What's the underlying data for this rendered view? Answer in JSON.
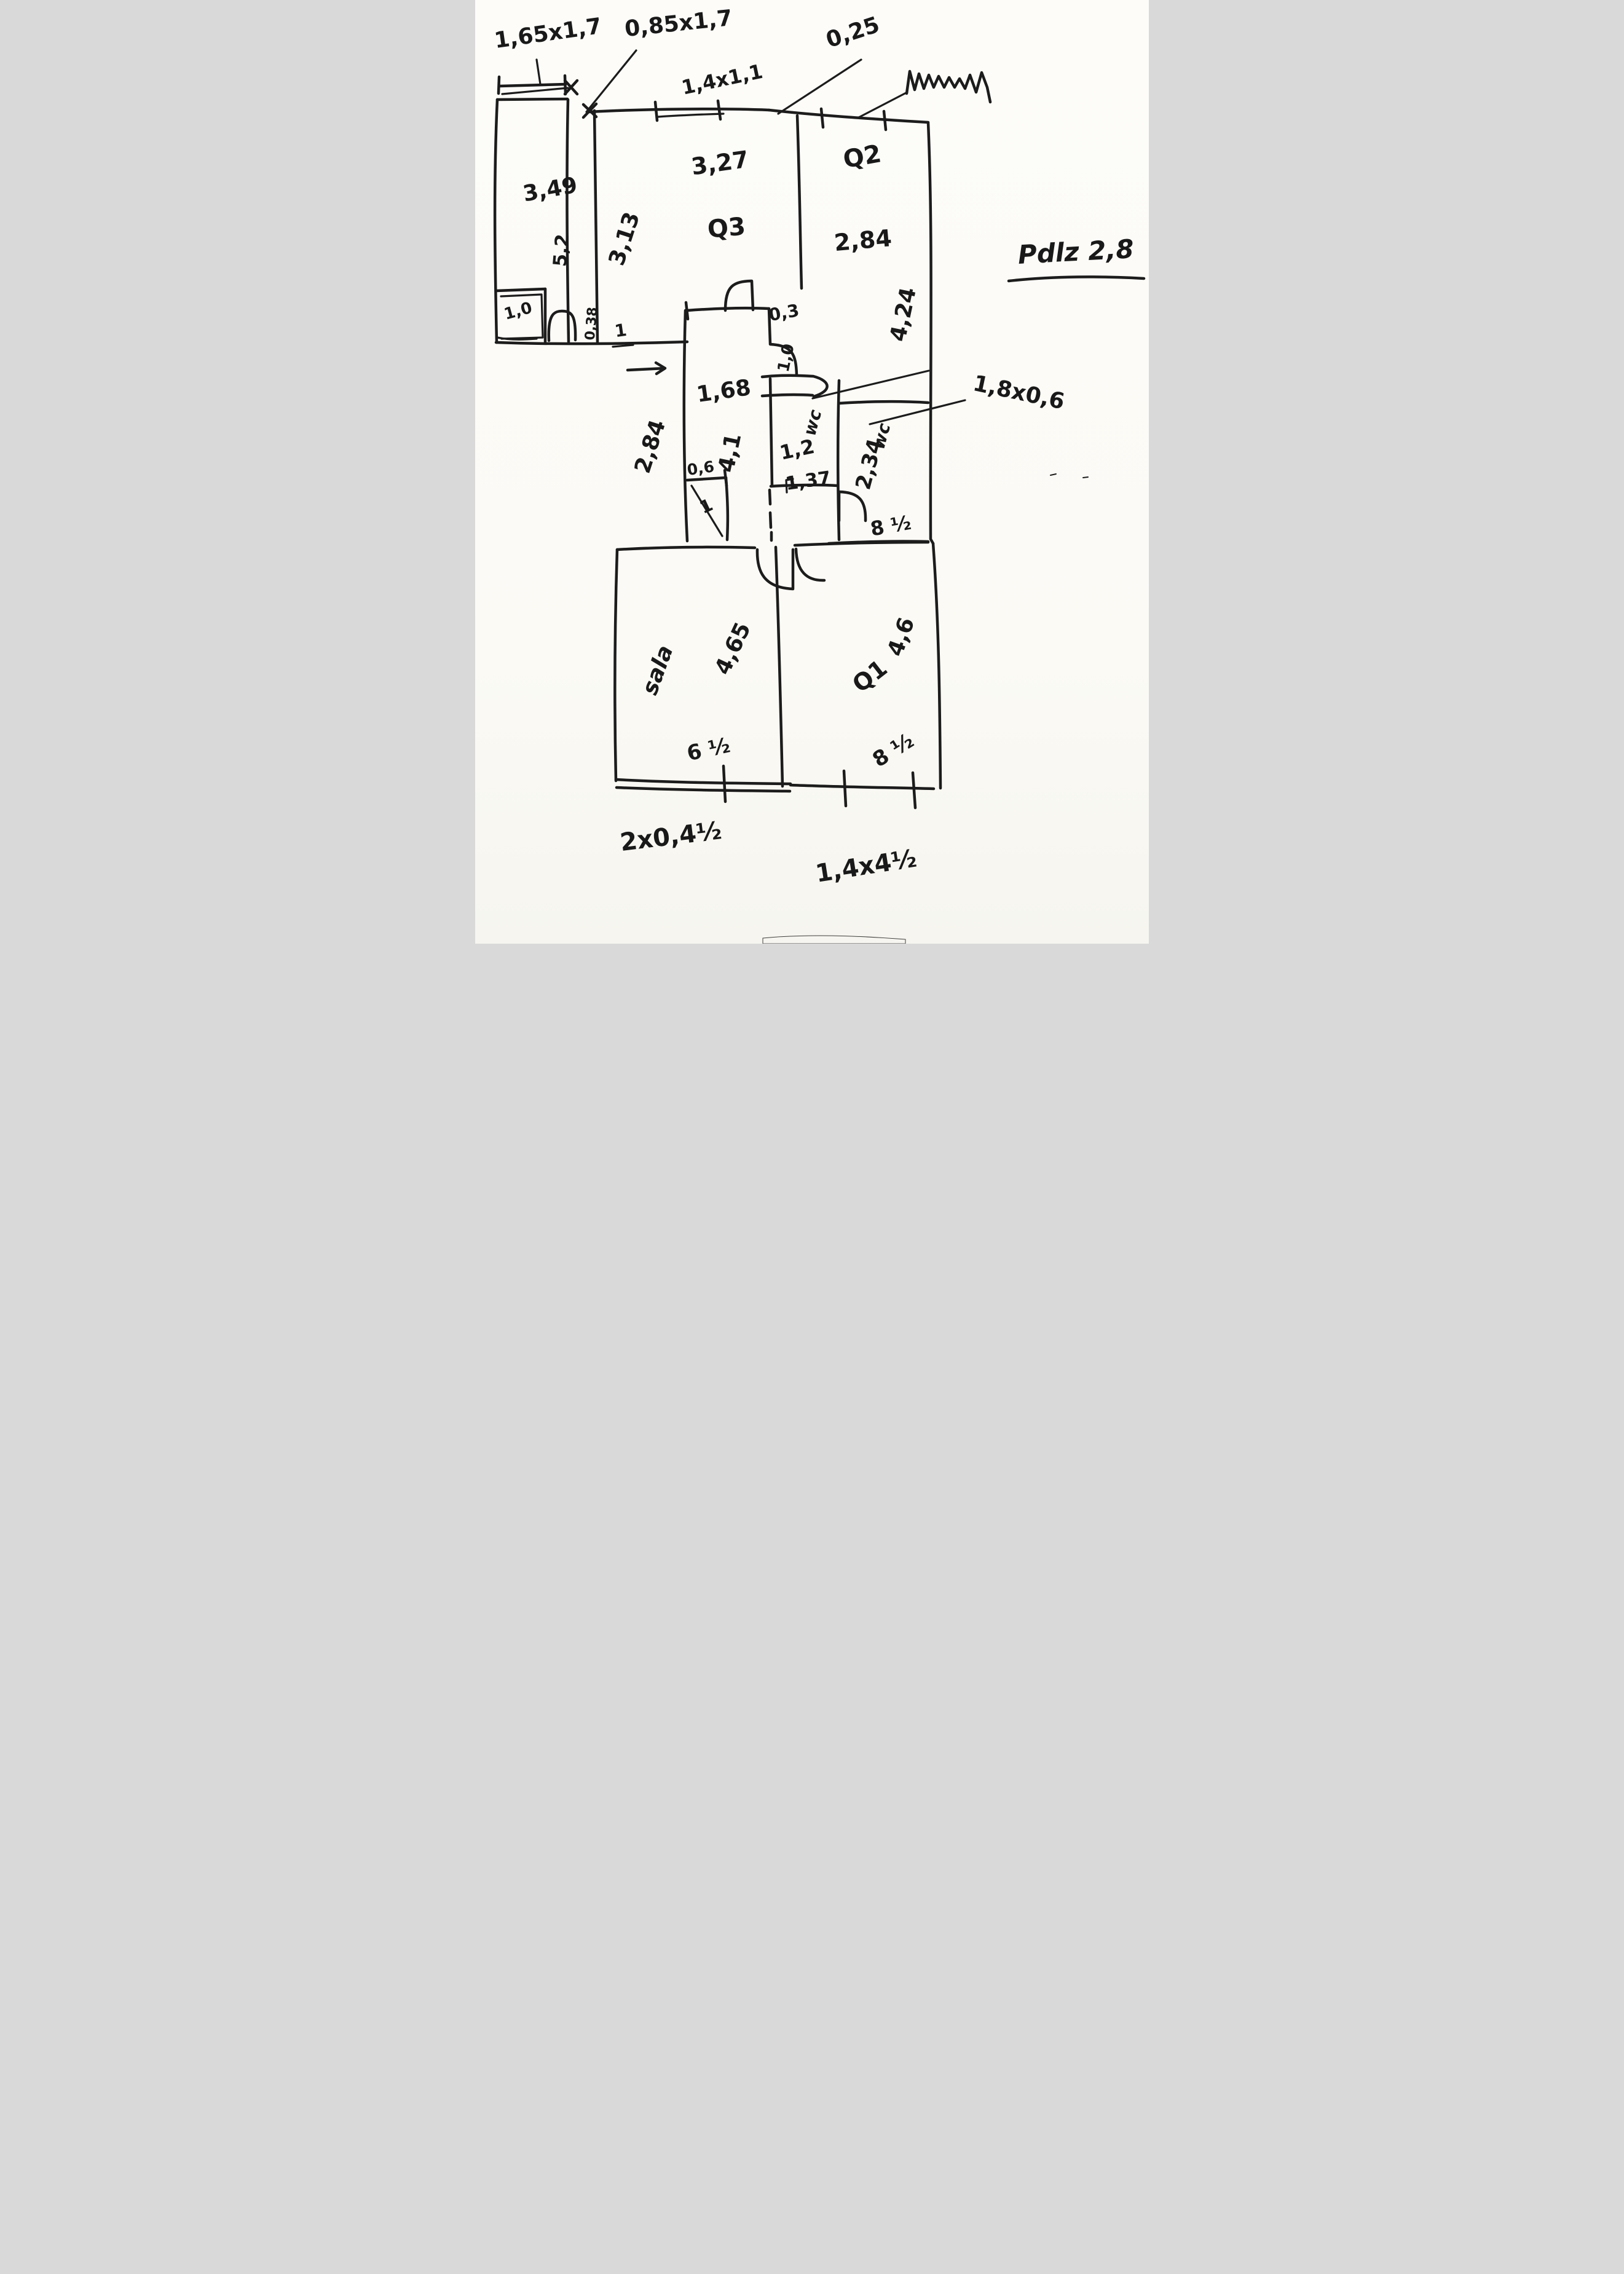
{
  "sketch": {
    "ink_color": "#1c1c1c",
    "paper_color": "#fcfbf7",
    "top_right_scribble": "(illegible handwriting)"
  },
  "annotations": {
    "top_left_window": "1,65x1,7",
    "top_left_door": "0,85x1,7",
    "top_window": "1,4x1,1",
    "top_offset": "0,25",
    "height_note": "Pdlz 2,8"
  },
  "rooms": {
    "hall": {
      "width": "3,49",
      "depth": "5,2",
      "recess_width": "1,0"
    },
    "q3": {
      "name": "Q3",
      "width": "3,27",
      "depth": "3,13"
    },
    "q2": {
      "name": "Q2",
      "width": "2,84",
      "depth": "4,24"
    },
    "corridor": {
      "width": "1,68",
      "length": "4,1",
      "side": "2,84",
      "top": "0,3",
      "door": "1,0",
      "wall": "0,38",
      "door_tick": "1"
    },
    "closet": {
      "width": "0,6",
      "depth": "1"
    },
    "wc_small": {
      "name": "wc",
      "width": "1,2",
      "depth": "1,37"
    },
    "wc_large": {
      "name": "wc",
      "depth": "2,34",
      "area": "8 ½",
      "niche": "1,8x0,6"
    },
    "sala": {
      "name": "sala",
      "length": "4,65",
      "area": "6 ½"
    },
    "q1": {
      "name": "Q1",
      "length": "4,6",
      "area": "8 ½"
    }
  },
  "bottom_dimensions": {
    "left": "2x0,4½",
    "right": "1,4x4½"
  }
}
